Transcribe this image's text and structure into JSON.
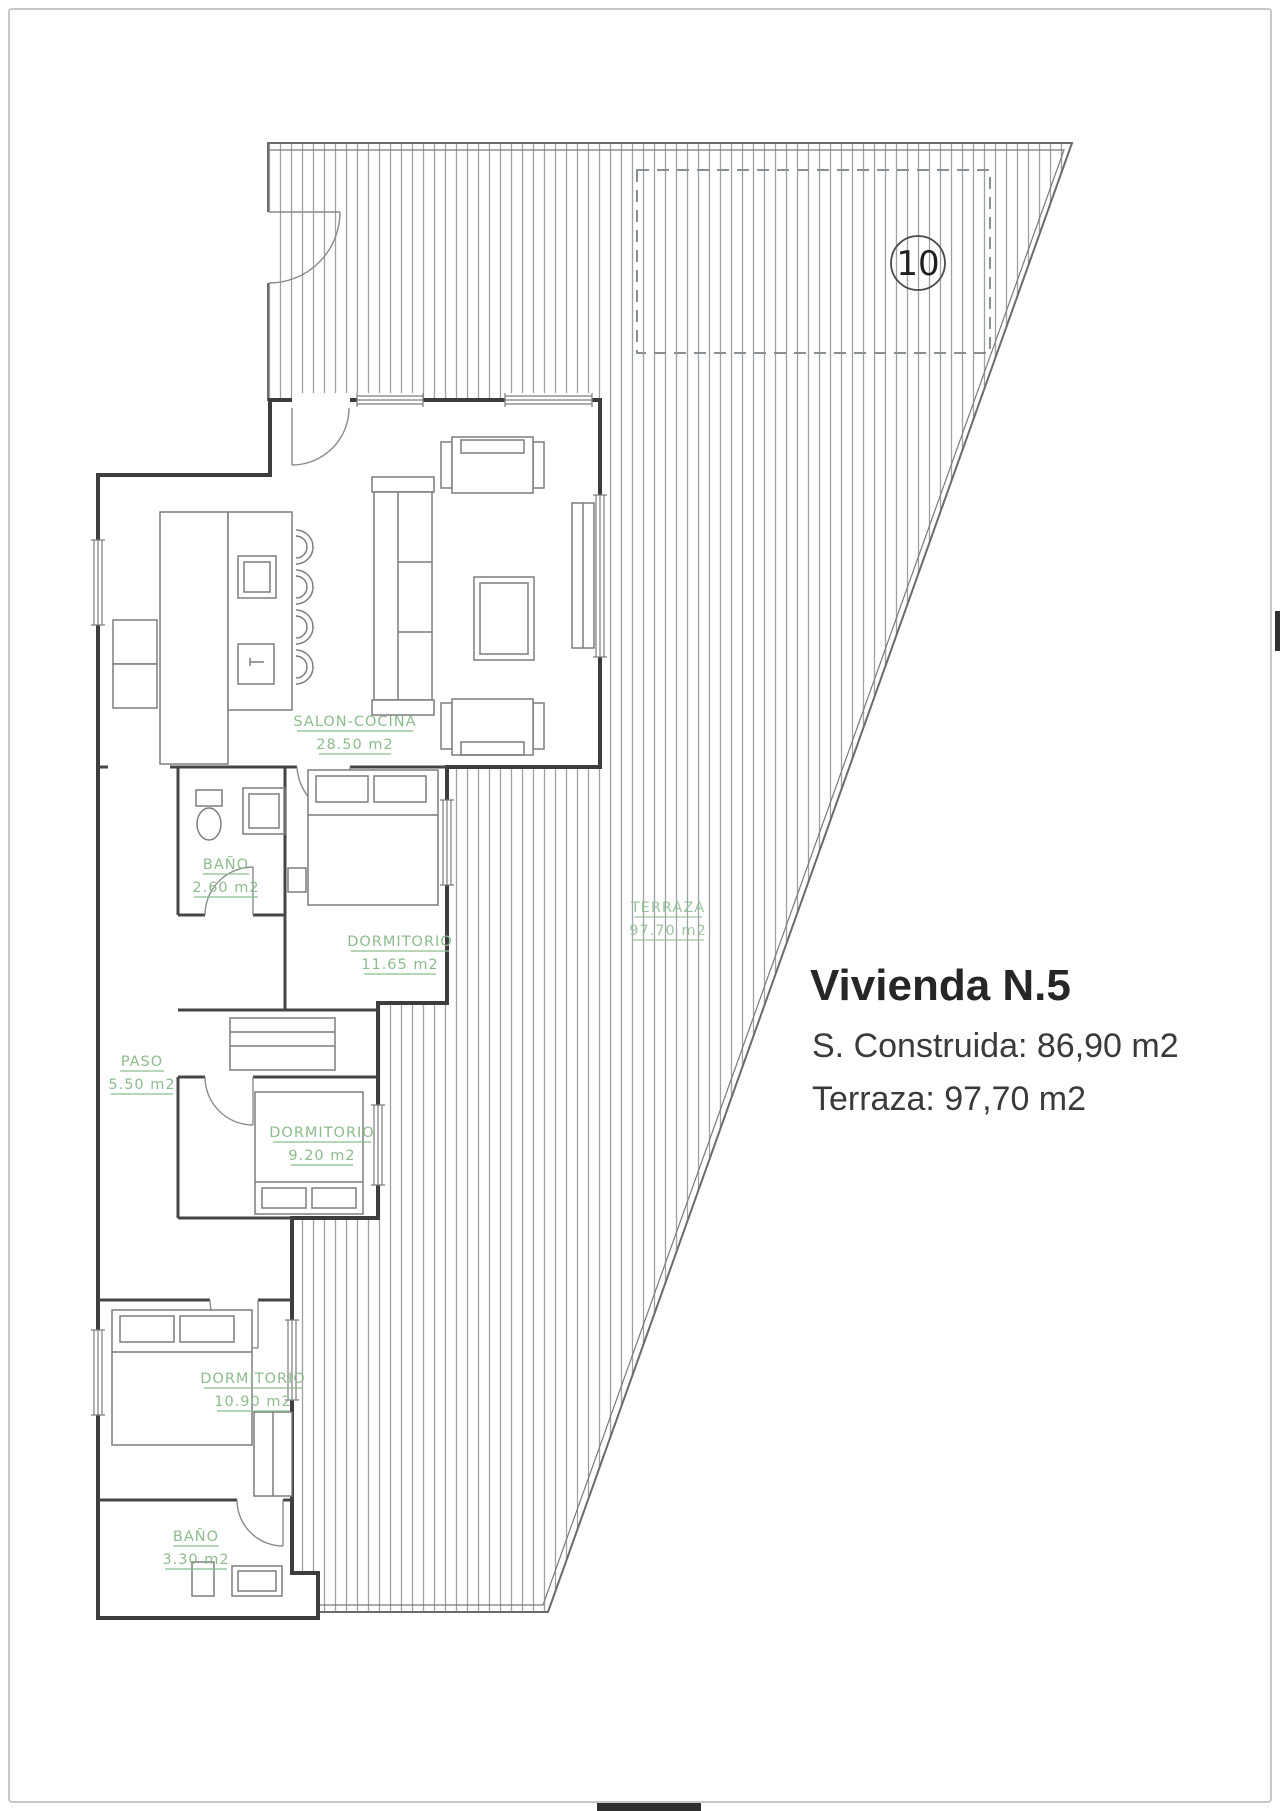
{
  "info_panel": {
    "title": "Vivienda N.5",
    "surface_line": "S. Construida: 86,90 m2",
    "terrace_line": "Terraza: 97,70 m2"
  },
  "plan": {
    "plot_marker": "10",
    "label_color": "#8cbc8c",
    "wall_color": "#3d3d3d",
    "hatch_color": "#9ba1a5",
    "rooms": [
      {
        "name": "SALON-COCINA",
        "area": "28.50 m2"
      },
      {
        "name": "BAÑO",
        "area": "2.60 m2"
      },
      {
        "name": "DORMITORIO",
        "area": "11.65 m2"
      },
      {
        "name": "PASO",
        "area": "5.50 m2"
      },
      {
        "name": "DORMITORIO",
        "area": "9.20 m2"
      },
      {
        "name": "DORMITORIO",
        "area": "10.90 m2"
      },
      {
        "name": "BAÑO",
        "area": "3.30 m2"
      },
      {
        "name": "TERRAZA",
        "area": "97.70 m2"
      }
    ]
  }
}
